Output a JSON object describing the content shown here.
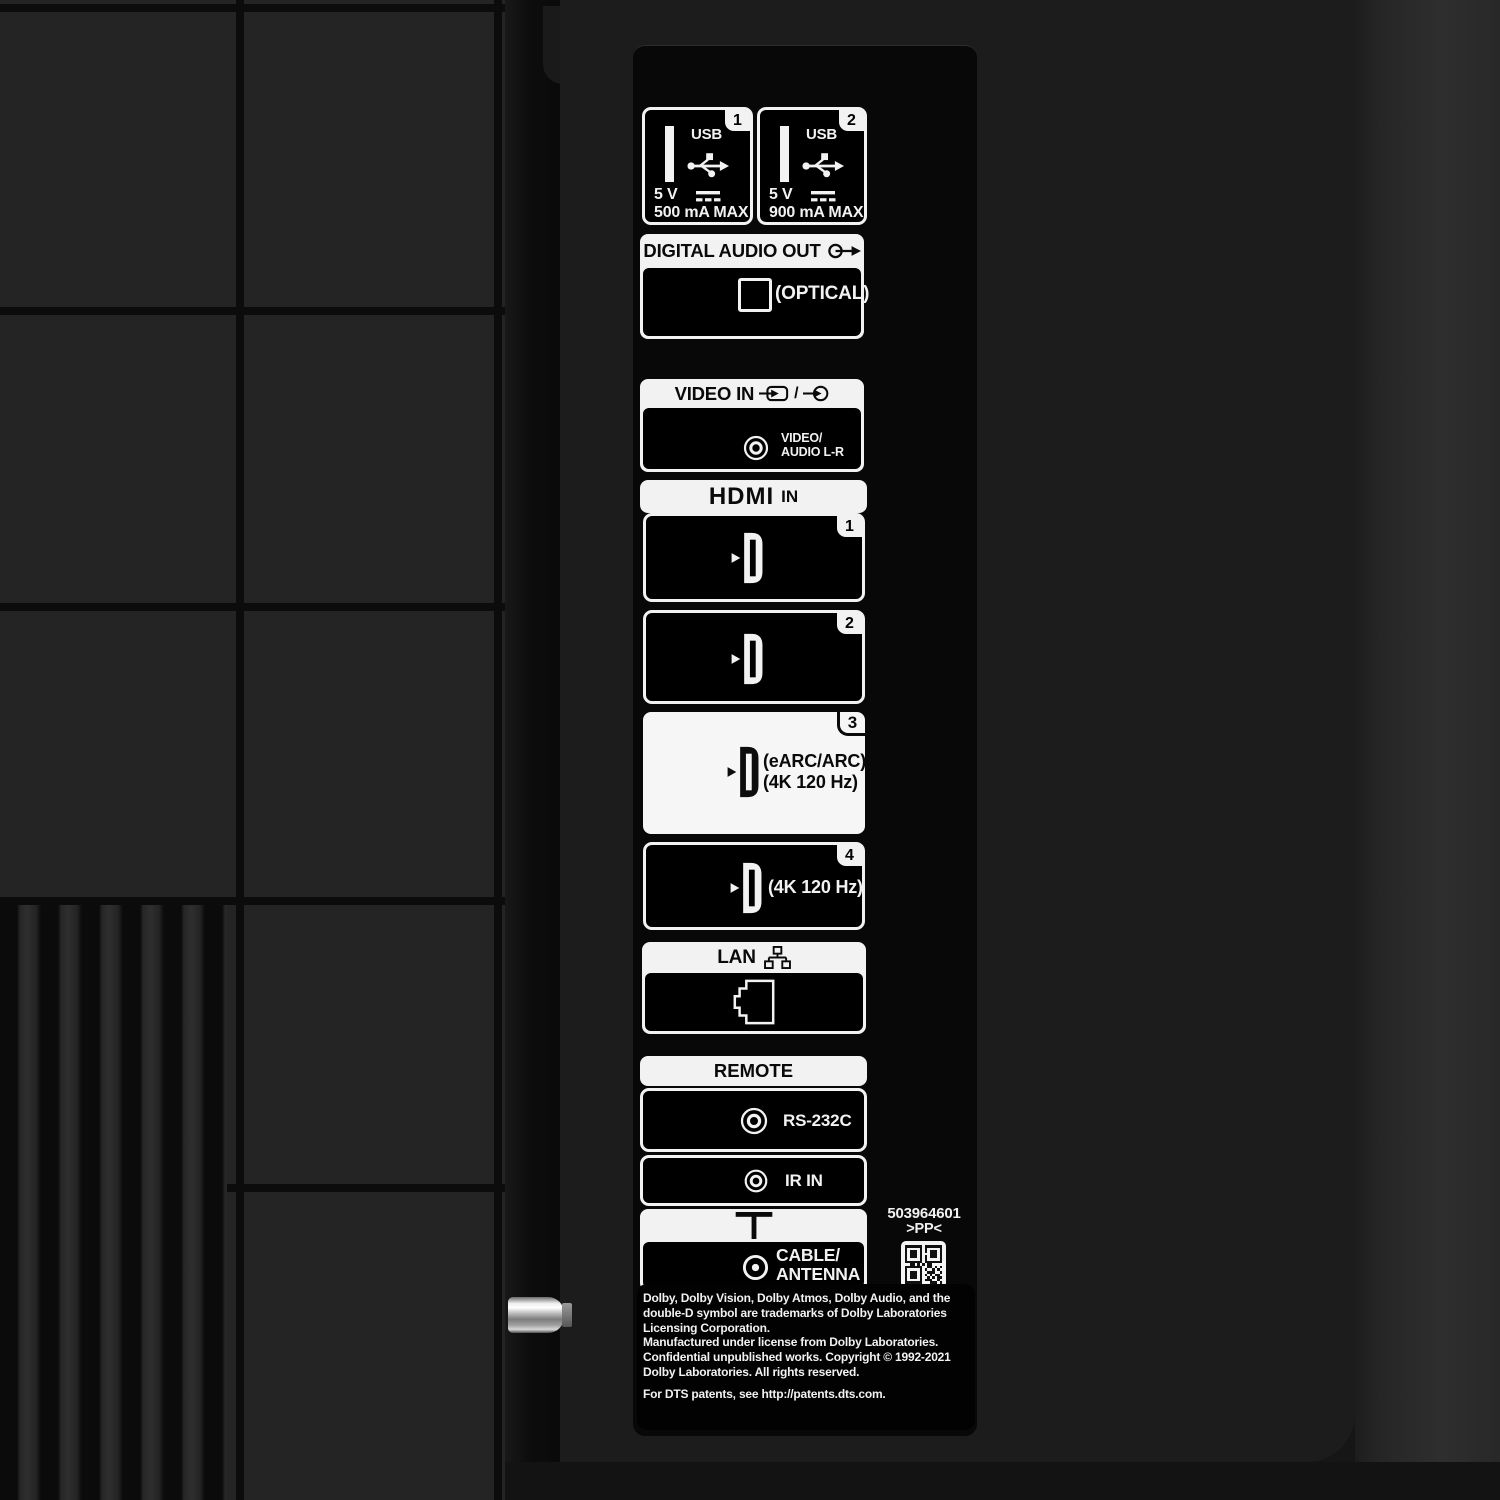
{
  "colors": {
    "label_white": "#f2f2f2",
    "panel_black": "#080808",
    "back_gray": "#242424"
  },
  "usb": {
    "ports": [
      {
        "number": "1",
        "label": "USB",
        "voltage": "5 V",
        "current": "500 mA MAX"
      },
      {
        "number": "2",
        "label": "USB",
        "voltage": "5 V",
        "current": "900 mA MAX"
      }
    ]
  },
  "digital_audio_out": {
    "title": "DIGITAL AUDIO OUT",
    "port": "(OPTICAL)"
  },
  "video_in": {
    "title": "VIDEO IN",
    "separator": "/",
    "port_line1": "VIDEO/",
    "port_line2": "AUDIO L-R"
  },
  "hdmi": {
    "logo": "HDMI",
    "suffix": "IN",
    "ports": [
      {
        "number": "1"
      },
      {
        "number": "2"
      },
      {
        "number": "3",
        "label_line1": "(eARC/ARC)",
        "label_line2": "(4K 120 Hz)"
      },
      {
        "number": "4",
        "label": "(4K 120 Hz)"
      }
    ]
  },
  "lan": {
    "title": "LAN"
  },
  "remote": {
    "title": "REMOTE",
    "ports": [
      {
        "label": "RS-232C"
      },
      {
        "label": "IR IN"
      }
    ]
  },
  "cable": {
    "line1": "CABLE/",
    "line2": "ANTENNA"
  },
  "serial": {
    "number": "503964601",
    "code": ">PP<"
  },
  "qr": {
    "pattern": [
      "111111101111111",
      "100000101000001",
      "101110101011101",
      "101110100011101",
      "101110101011101",
      "100000101000001",
      "111111101111111",
      "001101010110000",
      "111111100110101",
      "100000101001010",
      "101110100111001",
      "101110101010110",
      "101110100101011",
      "100000101110010",
      "111111100011101"
    ]
  },
  "legal": {
    "lines": [
      "Dolby, Dolby Vision, Dolby Atmos, Dolby Audio, and the",
      "double-D symbol are trademarks of Dolby Laboratories",
      "Licensing Corporation.",
      "Manufactured under license from Dolby Laboratories.",
      "Confidential unpublished works. Copyright © 1992-2021",
      "Dolby Laboratories. All rights reserved.",
      "For DTS patents, see http://patents.dts.com."
    ]
  }
}
